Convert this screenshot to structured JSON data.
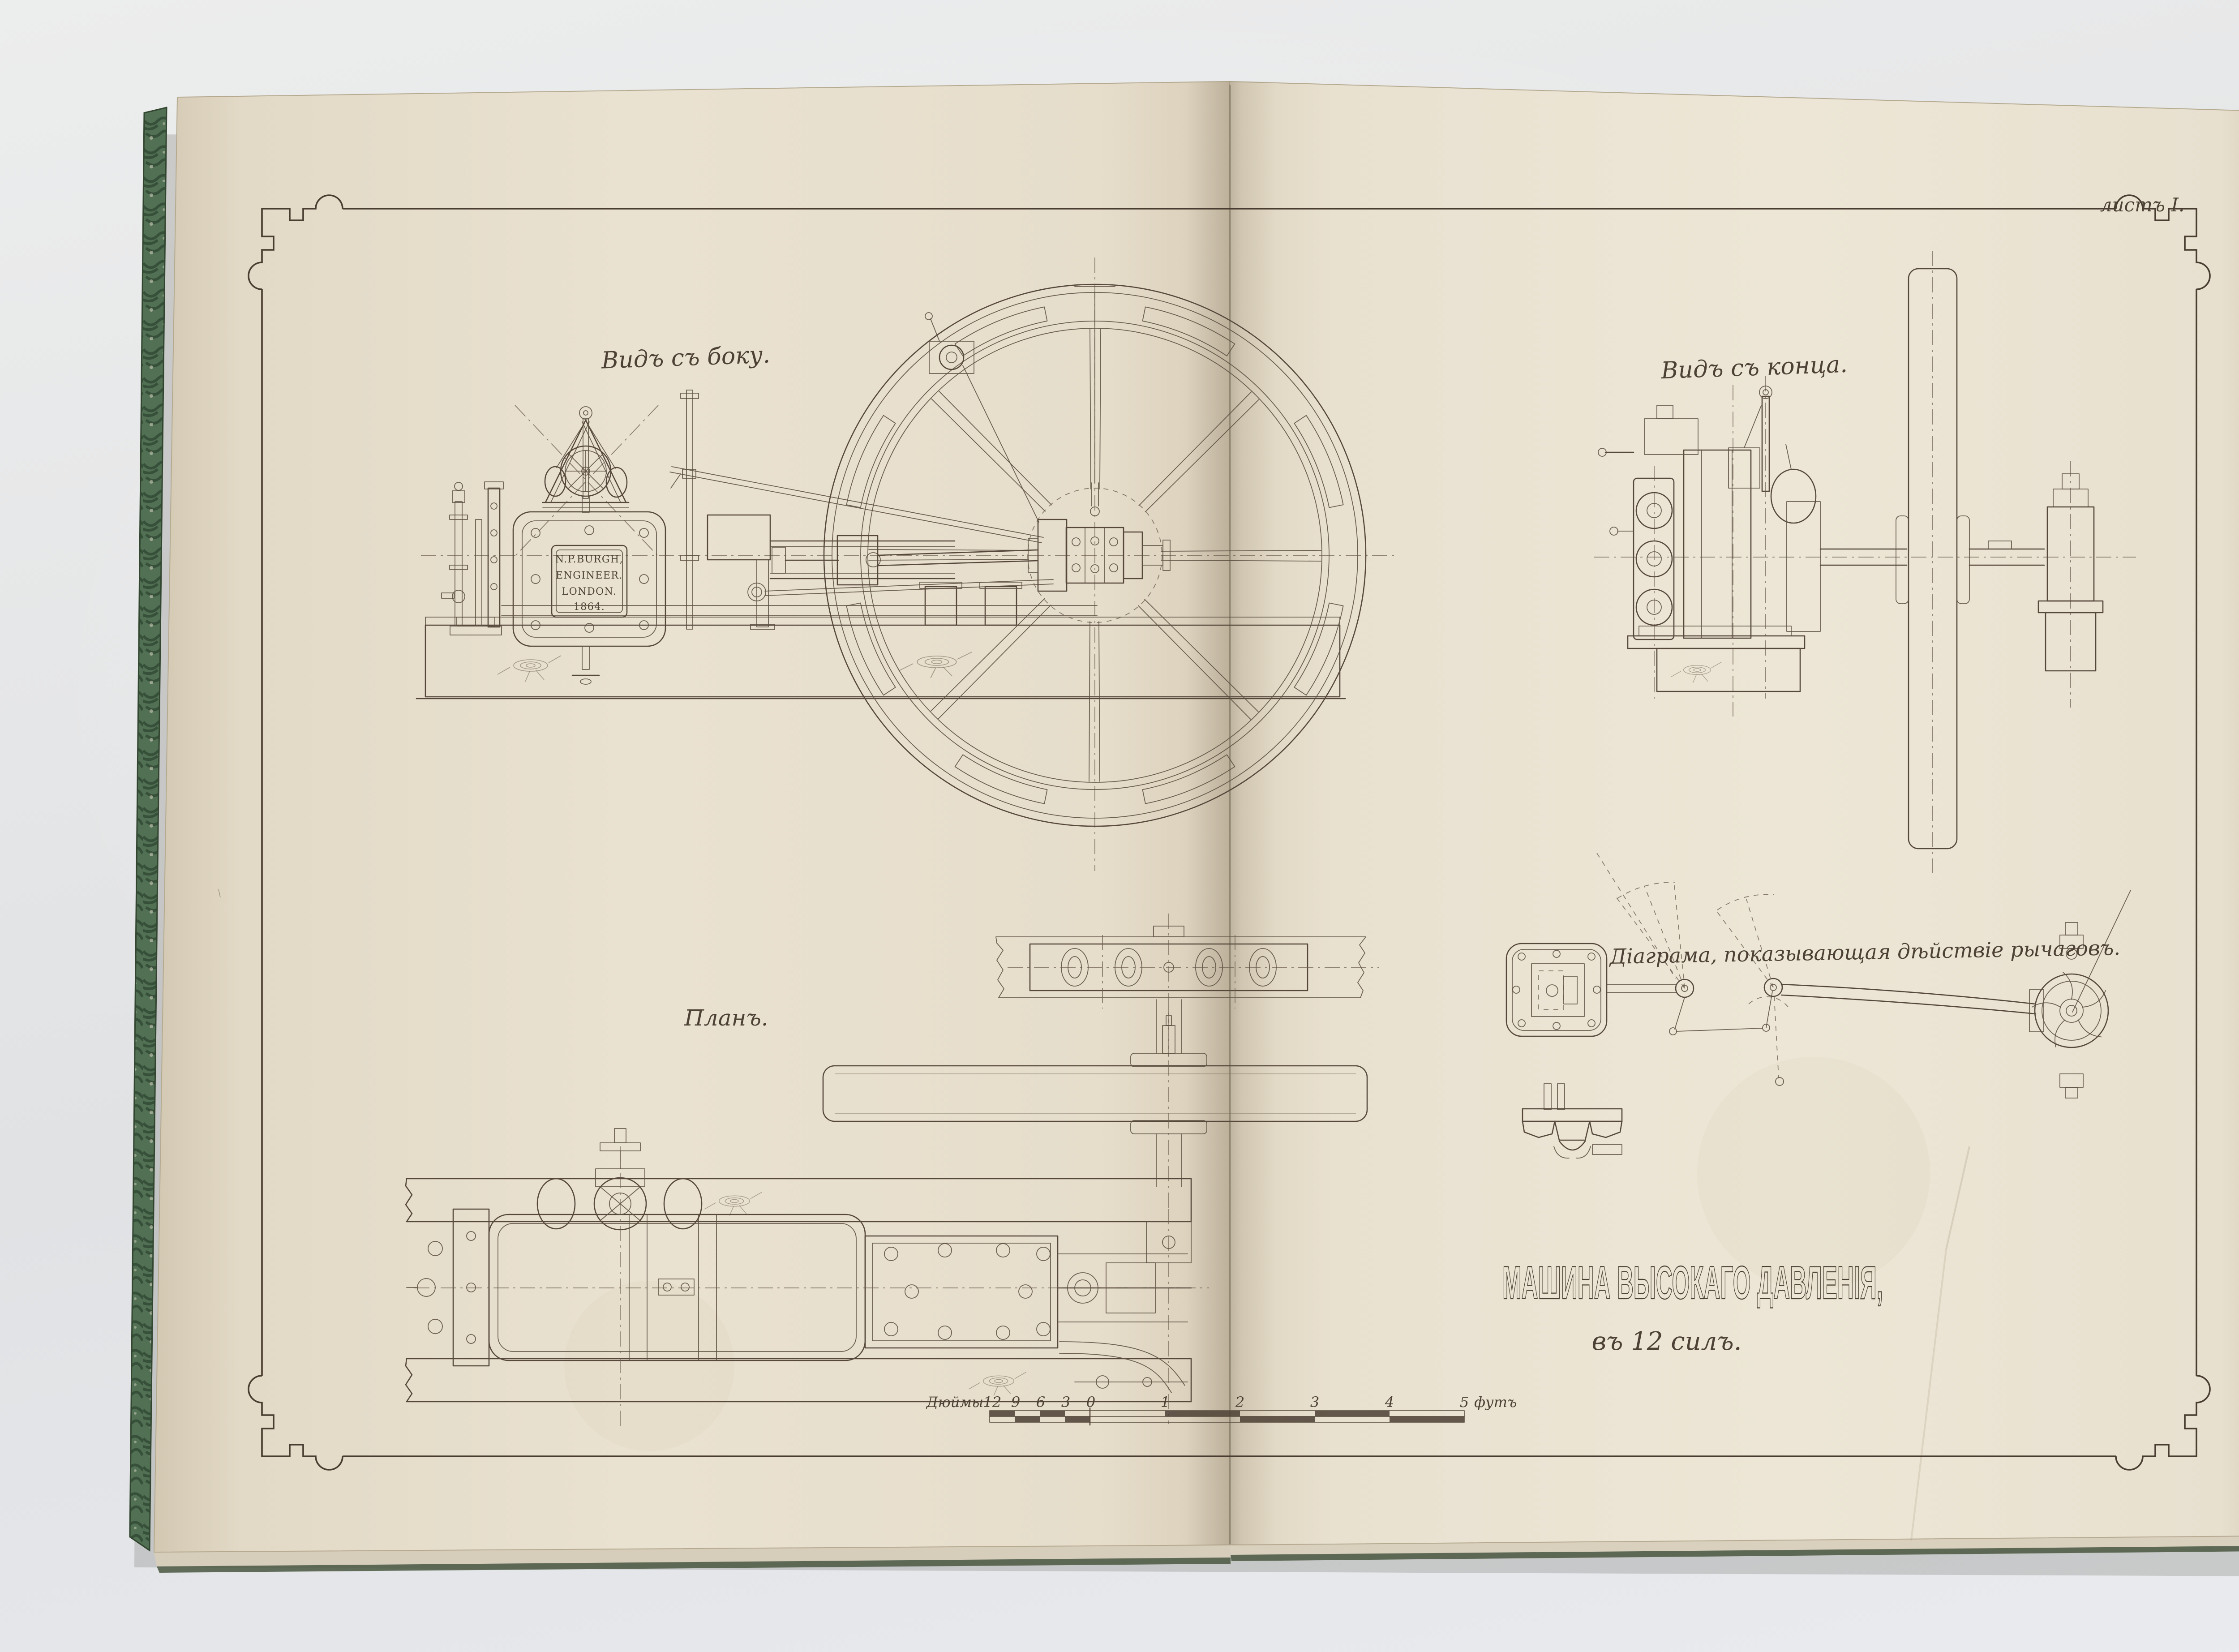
{
  "photo": {
    "backdrop_color": "#e5e6e8"
  },
  "book": {
    "cover_edge_color": "#4f6a52",
    "left_page_color": "#e8e0cf",
    "right_page_color": "#ebe4d4"
  },
  "plate": {
    "sheet_label": "листъ I.",
    "title": "МАШИНА ВЫСОКАГО ДАВЛЕНІЯ,",
    "subtitle": "въ 12 силъ.",
    "ink_color": "#55493d",
    "labels": {
      "side_view": "Видъ съ боку.",
      "end_view": "Видъ съ конца.",
      "plan": "Планъ.",
      "diagram": "Діаграма, показывающая дѣйствіе рычаговъ."
    },
    "maker_plate": [
      "N.P.BURGH,",
      "ENGINEER.",
      "LONDON.",
      "1864."
    ],
    "scale_bar": {
      "unit_left": "Дюймы",
      "ticks_inches": [
        "12",
        "9",
        "6",
        "3",
        "0"
      ],
      "ticks_feet": [
        "1",
        "2",
        "3",
        "4",
        "5"
      ],
      "unit_right": "футъ"
    }
  }
}
